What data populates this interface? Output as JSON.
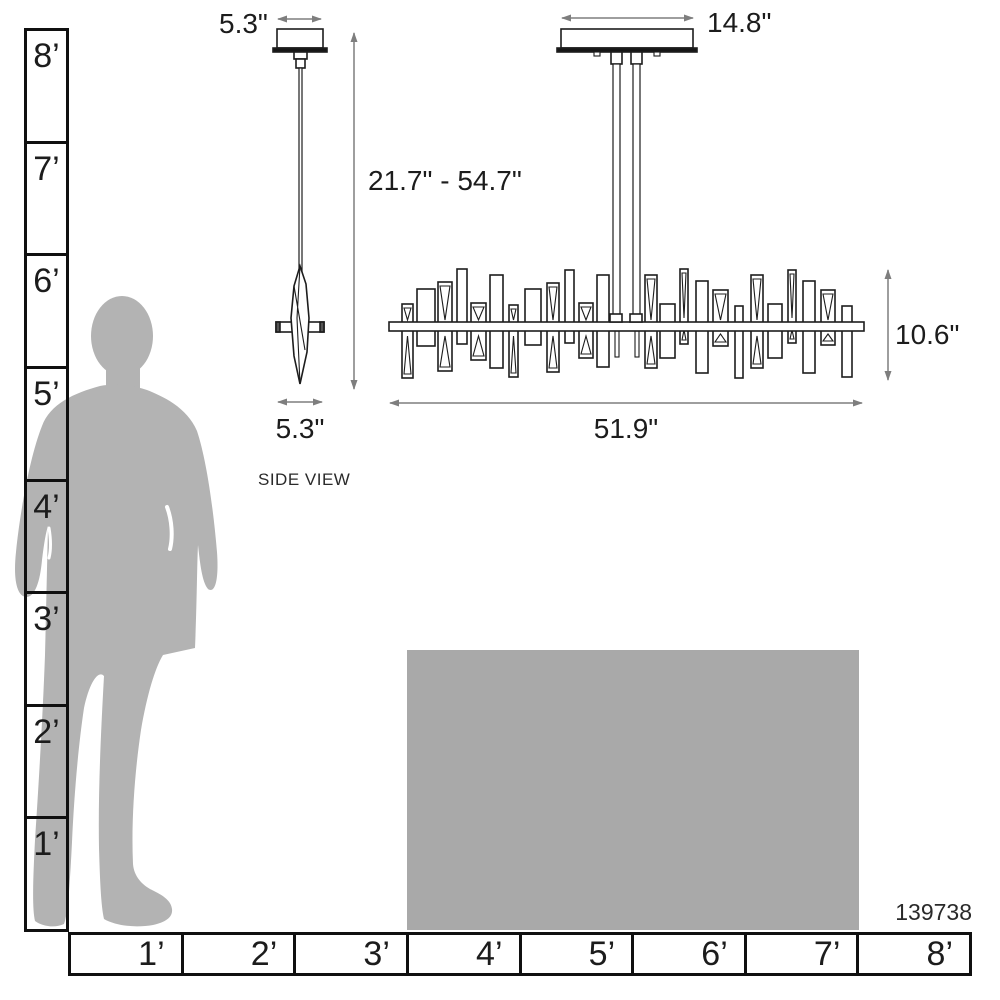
{
  "product": {
    "model_number": "139738"
  },
  "views": {
    "side": {
      "label": "SIDE VIEW",
      "canopy_width": "5.3\"",
      "fixture_width": "5.3\""
    },
    "front": {
      "canopy_width": "14.8\"",
      "height_range": "21.7\" - 54.7\"",
      "fixture_height": "10.6\"",
      "fixture_width": "51.9\""
    }
  },
  "scale_rulers": {
    "vertical_labels": [
      "8’",
      "7’",
      "6’",
      "5’",
      "4’",
      "3’",
      "2’",
      "1’"
    ],
    "horizontal_labels": [
      "1’",
      "2’",
      "3’",
      "4’",
      "5’",
      "6’",
      "7’",
      "8’"
    ]
  },
  "colors": {
    "silhouette_gray": "#b3b3b3",
    "table_gray": "#a9a9a9",
    "line_black": "#1d1d1d",
    "arrow_gray": "#7e7e7e"
  }
}
